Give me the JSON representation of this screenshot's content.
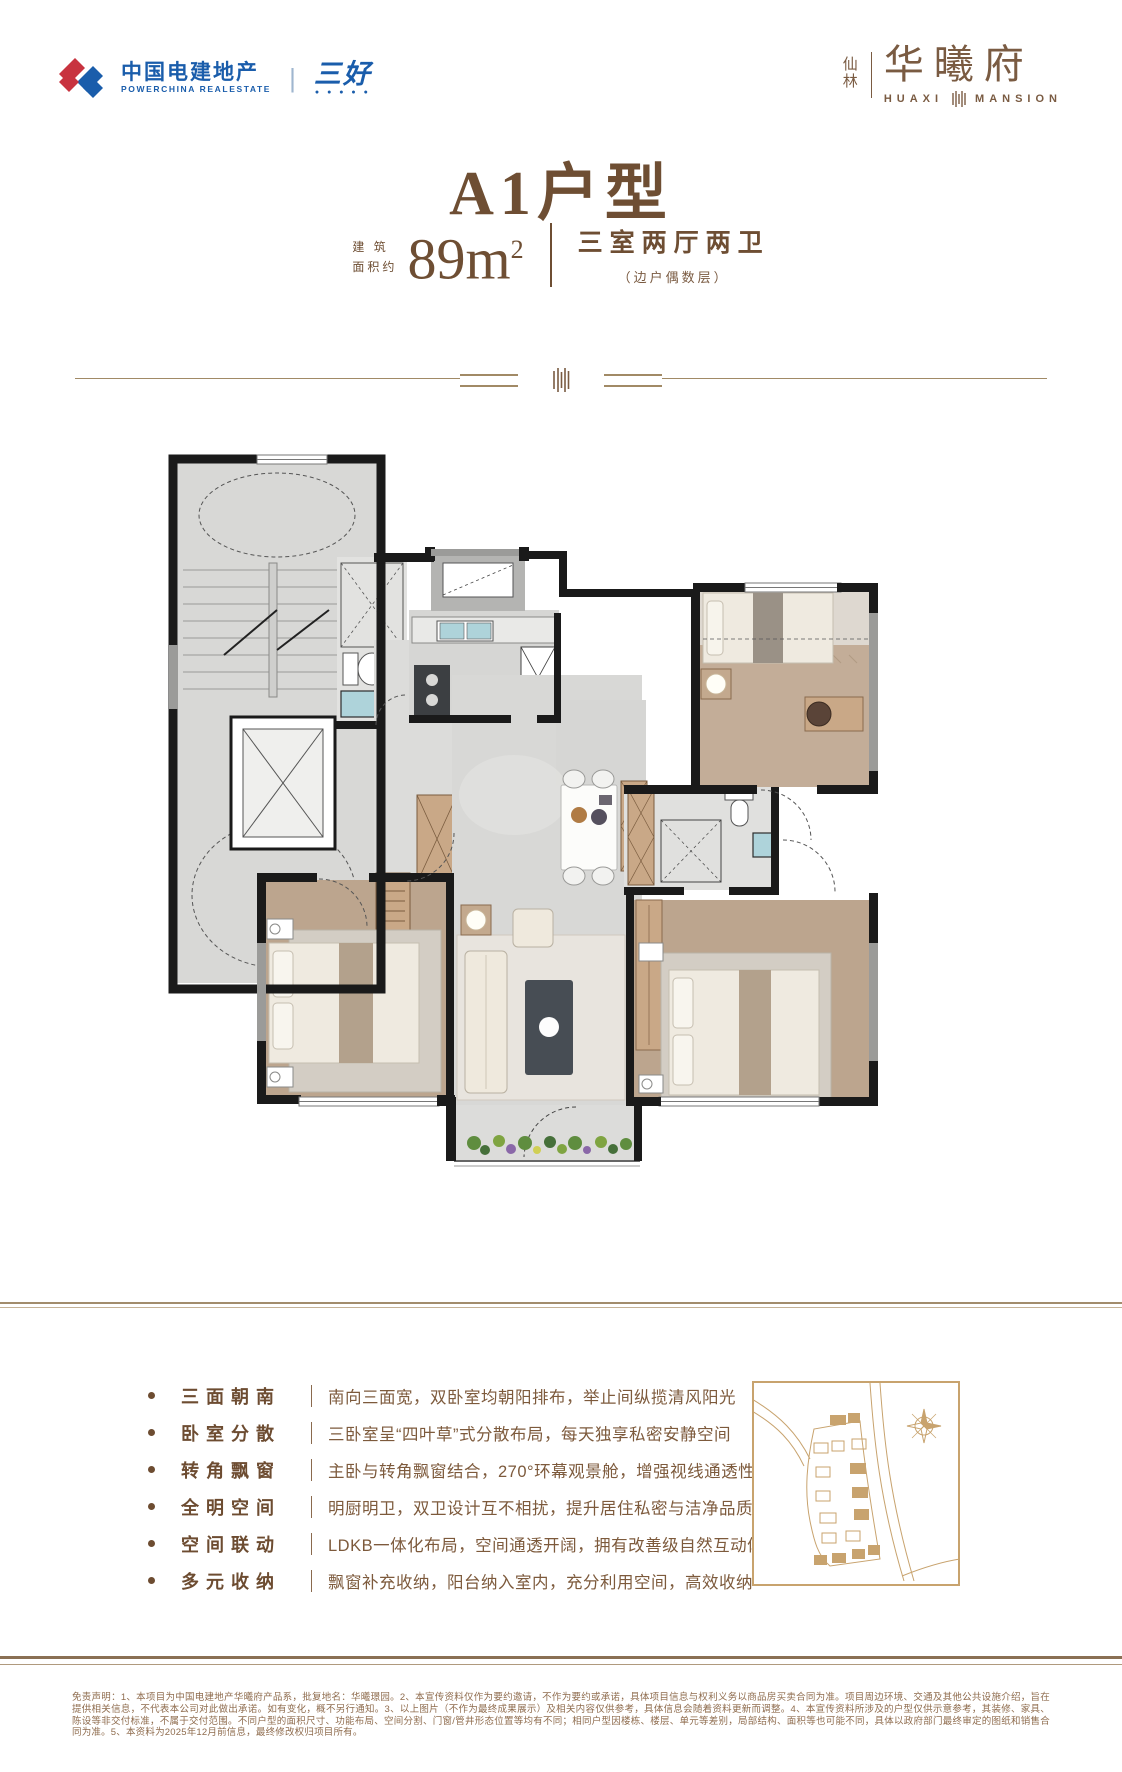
{
  "header": {
    "logo_cn": "中国电建地产",
    "logo_en": "POWERCHINA REALESTATE",
    "logo_sep": "|",
    "logo_badge": "三好",
    "logo_badge_dots": "● ● ● ● ●",
    "brand_loc_top": "仙",
    "brand_loc_bottom": "林",
    "brand_name": "华曦府",
    "brand_en_left": "HUAXI",
    "brand_en_right": "MANSION"
  },
  "title": {
    "main": "A1户型",
    "area_prefix_line1": "建 筑",
    "area_prefix_line2": "面积约",
    "area_value": "89m",
    "area_sup": "2",
    "rooms": "三室两厅两卫",
    "rooms_note": "（边户偶数层）"
  },
  "features": [
    {
      "label": "三面朝南",
      "desc": "南向三面宽，双卧室均朝阳排布，举止间纵揽清风阳光"
    },
    {
      "label": "卧室分散",
      "desc": "三卧室呈“四叶草”式分散布局，每天独享私密安静空间"
    },
    {
      "label": "转角飘窗",
      "desc": "主卧与转角飘窗结合，270°环幕观景舱，增强视线通透性"
    },
    {
      "label": "全明空间",
      "desc": "明厨明卫，双卫设计互不相扰，提升居住私密与洁净品质"
    },
    {
      "label": "空间联动",
      "desc": "LDKB一体化布局，空间通透开阔，拥有改善级自然互动体验"
    },
    {
      "label": "多元收纳",
      "desc": "飘窗补充收纳，阳台纳入室内，充分利用空间，高效收纳"
    }
  ],
  "disclaimer": "免责声明：1、本项目为中国电建地产华曦府产品系，批复地名：华曦璟园。2、本宣传资料仅作为要约邀请，不作为要约或承诺，具体项目信息与权利义务以商品房买卖合同为准。项目周边环境、交通及其他公共设施介绍，旨在提供相关信息，不代表本公司对此做出承诺。如有变化，概不另行通知。3、以上图片（不作为最终成果展示）及相关内容仅供参考，具体信息会随着资料更新而调整。4、本宣传资料所涉及的户型仅供示意参考，其装修、家具、陈设等非交付标准，不属于交付范围。不同户型的面积尺寸、功能布局、空间分割、门窗/管井形态位置等均有不同；相同户型因楼栋、楼层、单元等差别，局部结构、面积等也可能不同，具体以政府部门最终审定的图纸和销售合同为准。5、本资料为2025年12月前信息，最终修改权归项目所有。",
  "colors": {
    "brand_blue": "#1a5dab",
    "logo_red": "#c8333f",
    "title_brown": "#6e4e33",
    "text_brown": "#7d5a3c",
    "gold_line": "#a18a66",
    "sitemap_gold": "#c8a36e",
    "plan_wall": "#1a1a1a",
    "plan_marble": "#d8d8d6",
    "plan_wood": "#bca58e",
    "plan_sink_blue": "#aed3da"
  }
}
